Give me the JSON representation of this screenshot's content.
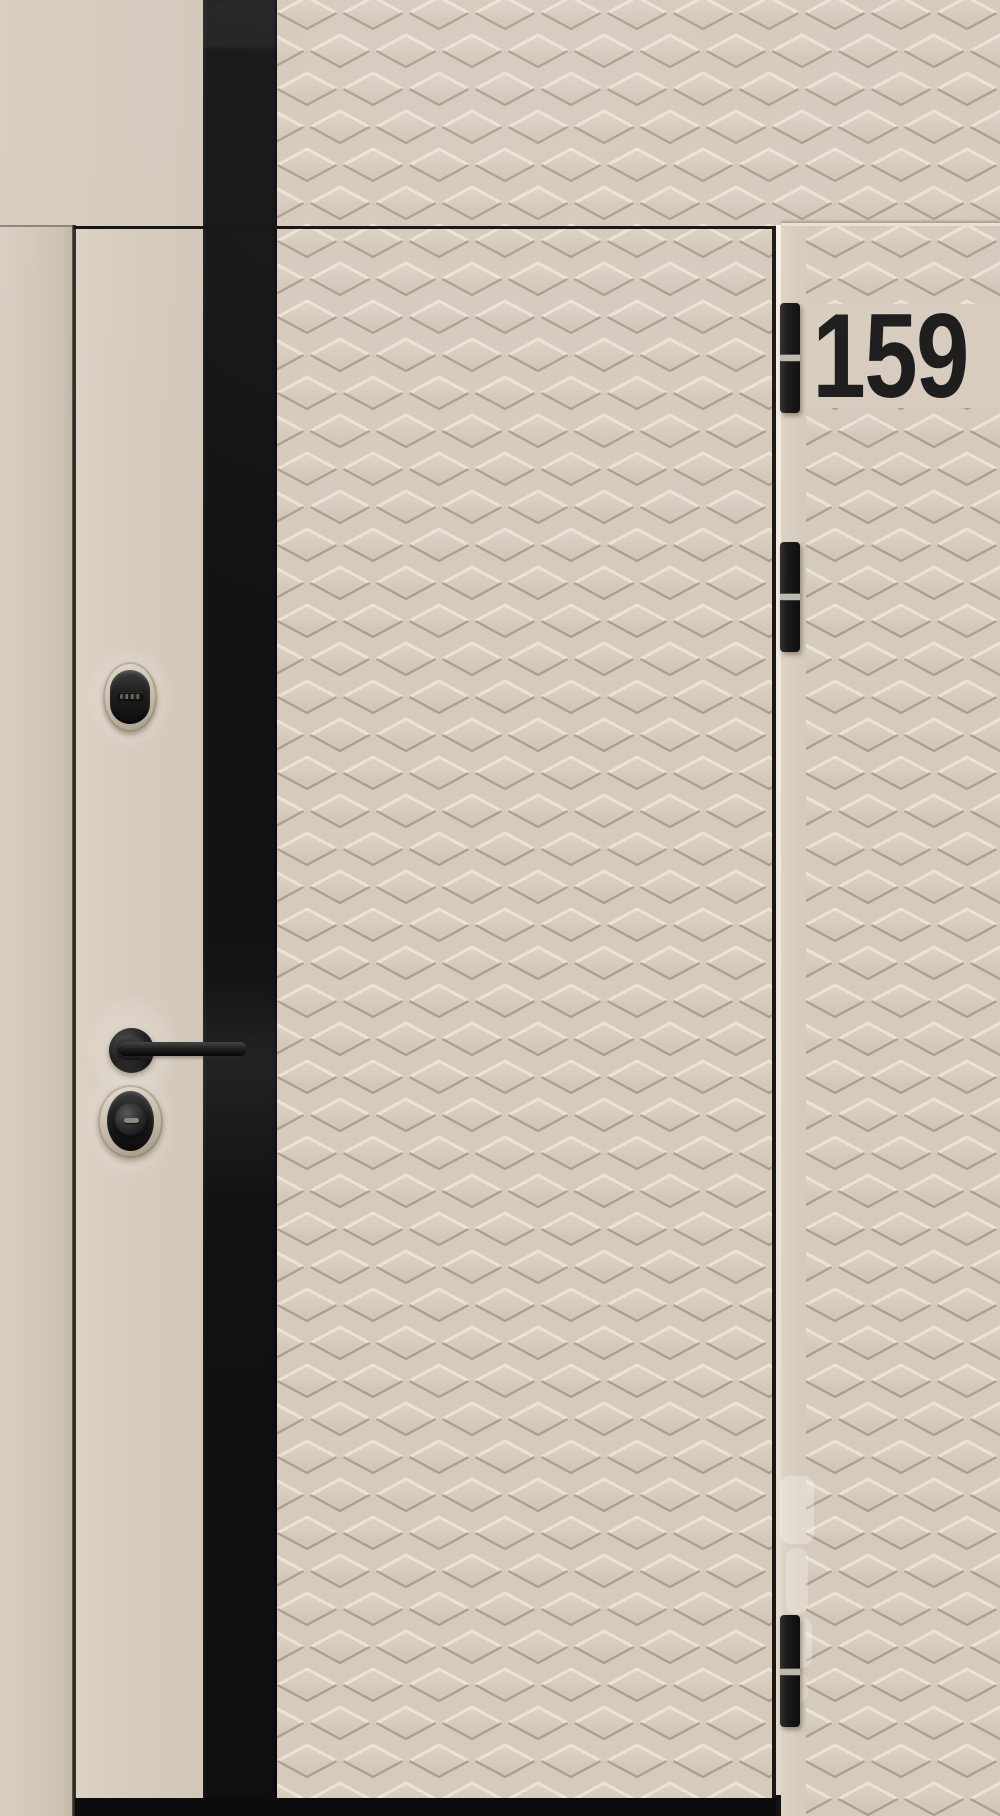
{
  "image": {
    "subject": "beige entrance door with diamond-embossed panels, black glass stripe and black hardware",
    "door_number": "159",
    "hardware": {
      "hinge_count": 3,
      "items": [
        "oval keyhole escutcheon",
        "lever handle on round rosette",
        "lock cylinder with round thumb-turn cover"
      ]
    },
    "colors": {
      "panel_beige": "#d5cabc",
      "texture_highlight": "#ece3d5",
      "texture_shadow": "#a39682",
      "glass_stripe_black": "#131415",
      "hardware_black": "#1d1d1d",
      "frame_gap_light": "#f1ebe0",
      "number_black": "#1c1c1c",
      "threshold_black": "#0c0c0c"
    }
  }
}
